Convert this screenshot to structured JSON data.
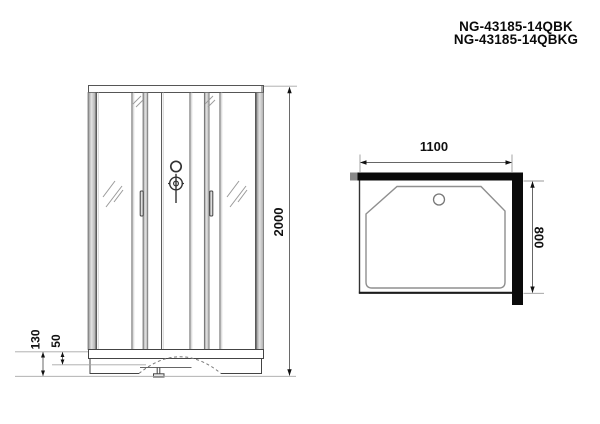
{
  "title": {
    "line1": "NG-43185-14QBK",
    "line2": "NG-43185-14QBKG"
  },
  "front_view": {
    "name": "shower-cabin-front-elevation",
    "dimensions": [
      {
        "id": "overall-height",
        "value": "2000",
        "unit": "mm",
        "orientation": "vertical"
      },
      {
        "id": "tray-total-height",
        "value": "130",
        "unit": "mm",
        "orientation": "vertical"
      },
      {
        "id": "tray-upper-height",
        "value": "50",
        "unit": "mm",
        "orientation": "vertical"
      }
    ],
    "features": [
      "sliding-doors",
      "glass-panels",
      "mixer-knob",
      "door-handles",
      "tray-apron",
      "adjustable-foot"
    ]
  },
  "top_view": {
    "name": "shower-tray-top-plan",
    "dimensions": [
      {
        "id": "width",
        "value": "1100",
        "unit": "mm",
        "orientation": "horizontal"
      },
      {
        "id": "depth",
        "value": "800",
        "unit": "mm",
        "orientation": "vertical"
      }
    ],
    "features": [
      "back-wall-profile",
      "side-wall-profile",
      "drain",
      "chamfered-tray"
    ]
  },
  "icons": [
    {
      "name": "shower-mixer-icon",
      "shape": "ring-and-knob-with-stem"
    },
    {
      "name": "door-handle-icon",
      "shape": "vertical-bar"
    },
    {
      "name": "drain-icon",
      "shape": "circle"
    }
  ],
  "colors": {
    "background": "#ffffff",
    "line_dark": "#333333",
    "line_medium": "#5a5a5a",
    "line_light": "#a0a0a0",
    "wall_black": "#0a0a0a",
    "alu_gray": "#b0b0b0",
    "text": "#0a0a0a"
  }
}
